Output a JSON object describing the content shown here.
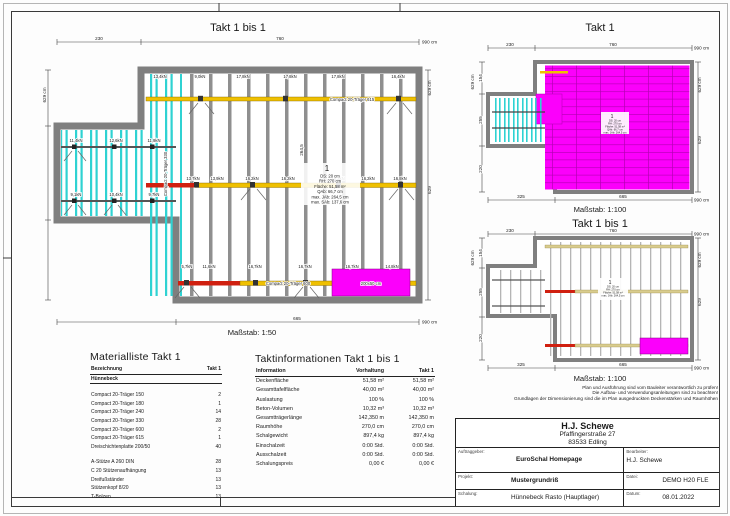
{
  "plan_large": {
    "title": "Takt 1 bis 1",
    "scale_label": "Maßstab: 1:50",
    "dims": {
      "w_left": "230",
      "w_right": "760",
      "w_total": "990 cm",
      "w_bottom": "665",
      "h_total": "629 cm",
      "h_inner": "629",
      "d_span": "264,5"
    },
    "beam_top": "Compact 20-Träger 615",
    "beam_bottom": "Compact 20-Träger 600",
    "beam_wing": "Compact 20-Träger 330",
    "panel_label": "200x50 cm",
    "loads": {
      "strip_top": "13,4kN",
      "top": [
        "9,0kN",
        "17,8kN",
        "17,8kN",
        "17,8kN",
        "16,4kN"
      ],
      "mid": [
        "13,7kN",
        "13,9kN",
        "16,2kN",
        "16,2kN",
        "16,2kN",
        "16,2kN",
        "16,8kN"
      ],
      "bottom": [
        "5,7kN",
        "11,6kN",
        "16,7kN",
        "16,7kN",
        "16,7kN",
        "14,8kN"
      ],
      "wing_top": [
        "11,4kN",
        "12,6kN",
        "11,9kN"
      ],
      "wing_bottom": [
        "9,1kN",
        "10,4kN",
        "9,7kN"
      ]
    }
  },
  "annotation_block": {
    "index": "1",
    "lines": [
      "DS: 20 cm",
      "RH: 270 cm",
      "Fläche: 51,58 m²",
      "QAb: 66,7 cm",
      "max. JAb: 264,5 cm",
      "max. SAb: 137,6 cm"
    ]
  },
  "plan_top_right": {
    "title": "Takt 1",
    "scale_label": "Maßstab: 1:100"
  },
  "plan_mid_right": {
    "title": "Takt 1 bis 1",
    "scale_label": "Maßstab: 1:100"
  },
  "dims100": {
    "w_left": "230",
    "w_right": "760",
    "w_total": "990 cm",
    "w_bottom_left": "325",
    "w_bottom": "665",
    "h_total": "629 cm",
    "h_inner": "629",
    "h_top": "154",
    "h_mid": "255",
    "h_bottom": "220"
  },
  "disclaimer": {
    "line1": "Plan und Ausführung sind vom Bauleiter verantwortlich zu prüfen!",
    "line2": "Die Aufbau- und Verwendungsanleitungen sind zu beachten!",
    "line3": "Grundlagen der Dimensionierung sind die im Plan ausgedruckten Deckenstärken und Raumhöhen"
  },
  "material_list": {
    "title": "Materialliste  Takt 1",
    "headers": {
      "name": "Bezeichnung",
      "qty": "Takt 1"
    },
    "group": "Hünnebeck",
    "items": [
      {
        "name": "Compact 20-Träger 150",
        "qty": "2"
      },
      {
        "name": "Compact 20-Träger 180",
        "qty": "1"
      },
      {
        "name": "Compact 20-Träger 240",
        "qty": "14"
      },
      {
        "name": "Compact 20-Träger 330",
        "qty": "28"
      },
      {
        "name": "Compact 20-Träger 600",
        "qty": "2"
      },
      {
        "name": "Compact 20-Träger 615",
        "qty": "1"
      },
      {
        "name": "Dreischichtenplatte 200/50",
        "qty": "40"
      }
    ],
    "items2": [
      {
        "name": "A-Stütze A 260 DIN",
        "qty": "28"
      },
      {
        "name": "C 20 Stützenaufhängung",
        "qty": "13"
      },
      {
        "name": "Dreifußständer",
        "qty": "13"
      },
      {
        "name": "Stützenkopf 8/20",
        "qty": "13"
      },
      {
        "name": "T-Bolzen",
        "qty": "13"
      }
    ]
  },
  "takt_info": {
    "title": "Taktinformationen  Takt 1 bis 1",
    "headers": [
      "Information",
      "Vorhaltung",
      "Takt 1"
    ],
    "rows": [
      {
        "label": "Deckenfläche",
        "vorhaltung": "51,58 m²",
        "takt": "51,58 m²"
      },
      {
        "label": "Gesamttafelfläche",
        "vorhaltung": "40,00 m²",
        "takt": "40,00 m²"
      },
      {
        "label": "Auslastung",
        "vorhaltung": "100 %",
        "takt": "100 %"
      },
      {
        "label": "Beton-Volumen",
        "vorhaltung": "10,32 m³",
        "takt": "10,32 m³"
      },
      {
        "label": "Gesamtträgerlänge",
        "vorhaltung": "142,350 m",
        "takt": "142,350 m"
      },
      {
        "label": "Raumhöhe",
        "vorhaltung": "270,0 cm",
        "takt": "270,0 cm"
      },
      {
        "label": "Schalgewicht",
        "vorhaltung": "897,4 kg",
        "takt": "897,4 kg"
      },
      {
        "label": "Einschalzeit",
        "vorhaltung": "0:00 Std.",
        "takt": "0:00 Std."
      },
      {
        "label": "Ausschalzeit",
        "vorhaltung": "0:00 Std.",
        "takt": "0:00 Std."
      },
      {
        "label": "Schalungspreis",
        "vorhaltung": "0,00 €",
        "takt": "0,00 €"
      }
    ]
  },
  "title_block": {
    "company": "H.J. Schewe",
    "address1": "Pfaffingerstraße 27",
    "address2": "83533 Edling",
    "labels": {
      "client": "Auftraggeber:",
      "editor": "Bearbeiter:",
      "project": "Projekt:",
      "file": "Datei:",
      "formwork": "Schalung:",
      "date": "Datum:"
    },
    "values": {
      "client": "EuroSchal Homepage",
      "editor": "H.J. Schewe",
      "project": "Mustergrundriß",
      "file": "DEMO H20 FLE",
      "formwork": "Hünnebeck Rasto (Hauptlager)",
      "date": "08.01.2022"
    }
  },
  "colors": {
    "wall": "#7f7f7f",
    "joist": "#8f8f8f",
    "cyan": "#2fd2d2",
    "yellow": "#efc000",
    "red": "#d02010",
    "magenta": "#fb00fb",
    "tan": "#d9cc8e"
  }
}
